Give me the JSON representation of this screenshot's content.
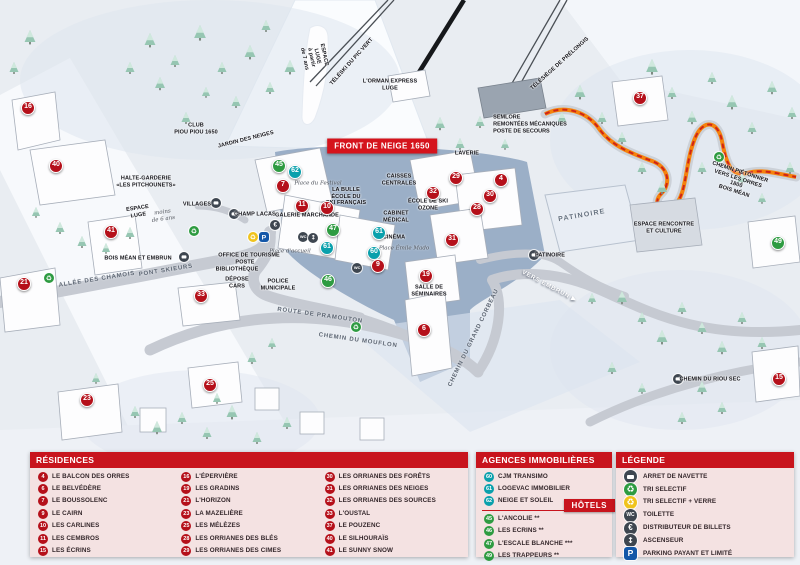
{
  "colors": {
    "primary_red": "#c8141d",
    "residence_red": "#b5101a",
    "hotel_green": "#2e9b41",
    "agency_teal": "#0aa0ac",
    "parking_blue": "#1457a8",
    "path_orange": "#f5820c"
  },
  "map": {
    "banner": "FRONT DE NEIGE 1650",
    "markers": [
      {
        "n": "16",
        "type": "r",
        "x": 28,
        "y": 108
      },
      {
        "n": "40",
        "type": "r",
        "x": 56,
        "y": 166
      },
      {
        "n": "41",
        "type": "r",
        "x": 111,
        "y": 232
      },
      {
        "n": "21",
        "type": "r",
        "x": 24,
        "y": 284
      },
      {
        "n": "33",
        "type": "r",
        "x": 201,
        "y": 296
      },
      {
        "n": "23",
        "type": "r",
        "x": 87,
        "y": 400
      },
      {
        "n": "25",
        "type": "r",
        "x": 210,
        "y": 385
      },
      {
        "n": "45",
        "type": "h",
        "x": 279,
        "y": 166
      },
      {
        "n": "62",
        "type": "a",
        "x": 295,
        "y": 172
      },
      {
        "n": "7",
        "type": "r",
        "x": 283,
        "y": 186
      },
      {
        "n": "11",
        "type": "r",
        "x": 302,
        "y": 206
      },
      {
        "n": "10",
        "type": "r",
        "x": 327,
        "y": 208
      },
      {
        "n": "47",
        "type": "h",
        "x": 333,
        "y": 230
      },
      {
        "n": "61",
        "type": "a",
        "x": 327,
        "y": 248
      },
      {
        "n": "61",
        "type": "a",
        "x": 379,
        "y": 233
      },
      {
        "n": "60",
        "type": "a",
        "x": 374,
        "y": 253
      },
      {
        "n": "9",
        "type": "r",
        "x": 378,
        "y": 266
      },
      {
        "n": "46",
        "type": "h",
        "x": 328,
        "y": 281
      },
      {
        "n": "19",
        "type": "r",
        "x": 426,
        "y": 276
      },
      {
        "n": "6",
        "type": "r",
        "x": 424,
        "y": 330
      },
      {
        "n": "29",
        "type": "r",
        "x": 456,
        "y": 178
      },
      {
        "n": "4",
        "type": "r",
        "x": 501,
        "y": 180
      },
      {
        "n": "32",
        "type": "r",
        "x": 433,
        "y": 193
      },
      {
        "n": "30",
        "type": "r",
        "x": 490,
        "y": 196
      },
      {
        "n": "28",
        "type": "r",
        "x": 477,
        "y": 209
      },
      {
        "n": "31",
        "type": "r",
        "x": 452,
        "y": 240
      },
      {
        "n": "37",
        "type": "r",
        "x": 640,
        "y": 98
      },
      {
        "n": "49",
        "type": "h",
        "x": 778,
        "y": 243
      },
      {
        "n": "15",
        "type": "r",
        "x": 779,
        "y": 379
      }
    ],
    "labels": [
      {
        "t": "CLUB\nPIOU PIOU 1650",
        "x": 196,
        "y": 129,
        "r": 0,
        "c": "poi"
      },
      {
        "t": "JARDIN DES NEIGES",
        "x": 246,
        "y": 140,
        "r": -14,
        "c": "poi"
      },
      {
        "t": "ESPACE\nLUGE\nà partir\nde 7 ans",
        "x": 314,
        "y": 57,
        "r": 78,
        "c": "poi"
      },
      {
        "t": "TÉLÉSKI DU PIC VERT",
        "x": 352,
        "y": 62,
        "r": -48,
        "c": "poi"
      },
      {
        "t": "L'ORMAN EXPRESS\nLUGE",
        "x": 390,
        "y": 85,
        "r": 0,
        "c": "poi"
      },
      {
        "t": "TÉLÉSIÈGE DE PRÉLONGIS",
        "x": 560,
        "y": 64,
        "r": -42,
        "c": "poi"
      },
      {
        "t": "SEMLORE\nREMONTÉES MÉCANIQUES\nPOSTE DE SECOURS",
        "x": 530,
        "y": 125,
        "r": 0,
        "c": "poileft"
      },
      {
        "t": "LAVERIE",
        "x": 467,
        "y": 154,
        "r": 0,
        "c": "poi"
      },
      {
        "t": "HALTE-GARDERIE\n«LES PITCHOUNETS»",
        "x": 146,
        "y": 182,
        "r": 0,
        "c": "poi"
      },
      {
        "t": "VILLAGES",
        "x": 197,
        "y": 205,
        "r": 0,
        "c": "poi"
      },
      {
        "t": "ESPACE\nLUGE",
        "x": 138,
        "y": 212,
        "r": -8,
        "c": "poi"
      },
      {
        "t": "moins\nde 6 ans",
        "x": 163,
        "y": 216,
        "r": -8,
        "c": "place"
      },
      {
        "t": "CHAMP LACAS",
        "x": 255,
        "y": 215,
        "r": 0,
        "c": "poi"
      },
      {
        "t": "BOIS MÉAN ET EMBRUN",
        "x": 138,
        "y": 259,
        "r": 0,
        "c": "poi"
      },
      {
        "t": "OFFICE DE TOURISME",
        "x": 249,
        "y": 256,
        "r": 0,
        "c": "poi"
      },
      {
        "t": "POSTE",
        "x": 245,
        "y": 263,
        "r": 0,
        "c": "poi"
      },
      {
        "t": "BIBLIOTHÈQUE",
        "x": 237,
        "y": 270,
        "r": 0,
        "c": "poi"
      },
      {
        "t": "DÉPOSE\nCARS",
        "x": 237,
        "y": 283,
        "r": 0,
        "c": "poi"
      },
      {
        "t": "POLICE\nMUNICIPALE",
        "x": 278,
        "y": 285,
        "r": 0,
        "c": "poi"
      },
      {
        "t": "Place d'accueil",
        "x": 290,
        "y": 252,
        "r": 0,
        "c": "place"
      },
      {
        "t": "Place du Festival",
        "x": 318,
        "y": 184,
        "r": 0,
        "c": "place"
      },
      {
        "t": "Place Émile Mado",
        "x": 404,
        "y": 249,
        "r": 0,
        "c": "place"
      },
      {
        "t": "LA BULLE\nÉCOLE DU\nSKI FRANÇAIS",
        "x": 346,
        "y": 197,
        "r": 0,
        "c": "poi"
      },
      {
        "t": "GALERIE MARCHANDE",
        "x": 307,
        "y": 216,
        "r": 0,
        "c": "poi"
      },
      {
        "t": "CAISSES\nCENTRALES",
        "x": 399,
        "y": 180,
        "r": 0,
        "c": "poi"
      },
      {
        "t": "CABINET\nMÉDICAL",
        "x": 396,
        "y": 217,
        "r": 0,
        "c": "poi"
      },
      {
        "t": "CINÉMA",
        "x": 394,
        "y": 238,
        "r": 0,
        "c": "poi"
      },
      {
        "t": "ÉCOLE DE SKI\nOZONE",
        "x": 428,
        "y": 205,
        "r": 0,
        "c": "poi"
      },
      {
        "t": "SALLE DE\nSÉMINAIRES",
        "x": 429,
        "y": 291,
        "r": 0,
        "c": "poi"
      },
      {
        "t": "PATINOIRE",
        "x": 550,
        "y": 256,
        "r": 0,
        "c": "poi"
      },
      {
        "t": "PATINOIRE",
        "x": 582,
        "y": 216,
        "r": -10,
        "c": "rink"
      },
      {
        "t": "ESPACE RENCONTRE\nET CULTURE",
        "x": 664,
        "y": 228,
        "r": 0,
        "c": "poi"
      },
      {
        "t": "CHEMIN PIÉTONNIER\nVERS LES ORRES 1800\nBOIS MÉAN",
        "x": 737,
        "y": 182,
        "r": 18,
        "c": "poi"
      },
      {
        "t": "CHEMIN DU RIOU SEC",
        "x": 710,
        "y": 380,
        "r": 0,
        "c": "poi"
      },
      {
        "t": "ALLÉE DES CHAMOIS",
        "x": 97,
        "y": 280,
        "r": -9,
        "c": "road"
      },
      {
        "t": "PONT SKIEURS",
        "x": 166,
        "y": 271,
        "r": -9,
        "c": "road"
      },
      {
        "t": "ROUTE DE PRAMOUTON",
        "x": 320,
        "y": 316,
        "r": 8,
        "c": "road"
      },
      {
        "t": "CHEMIN DU MOUFLON",
        "x": 358,
        "y": 341,
        "r": 8,
        "c": "road"
      },
      {
        "t": "CHEMIN DU GRAND CORBEAU",
        "x": 474,
        "y": 338,
        "r": -64,
        "c": "road"
      },
      {
        "t": "VERS EMBRUN ▶",
        "x": 549,
        "y": 287,
        "r": 28,
        "c": "roadwhite"
      }
    ],
    "icons": [
      {
        "k": "bus",
        "x": 216,
        "y": 203
      },
      {
        "k": "bus",
        "x": 234,
        "y": 214
      },
      {
        "k": "bus",
        "x": 184,
        "y": 257
      },
      {
        "k": "bus",
        "x": 534,
        "y": 255
      },
      {
        "k": "bus",
        "x": 678,
        "y": 379
      },
      {
        "k": "recycle",
        "x": 194,
        "y": 231
      },
      {
        "k": "recycle",
        "x": 49,
        "y": 278
      },
      {
        "k": "recycle",
        "x": 356,
        "y": 327
      },
      {
        "k": "recycle",
        "x": 719,
        "y": 157
      },
      {
        "k": "glass",
        "x": 253,
        "y": 237
      },
      {
        "k": "park",
        "x": 264,
        "y": 237
      },
      {
        "k": "euro",
        "x": 275,
        "y": 225
      },
      {
        "k": "wc",
        "x": 303,
        "y": 237
      },
      {
        "k": "lift",
        "x": 313,
        "y": 238
      },
      {
        "k": "wc",
        "x": 357,
        "y": 268
      }
    ]
  },
  "legend": {
    "residences": {
      "title": "RÉSIDENCES",
      "items": [
        {
          "n": "4",
          "label": "LE BALCON DES ORRES"
        },
        {
          "n": "6",
          "label": "LE BELVÉDÈRE"
        },
        {
          "n": "7",
          "label": "LE BOUSSOLENC"
        },
        {
          "n": "9",
          "label": "LE CAIRN"
        },
        {
          "n": "10",
          "label": "LES CARLINES"
        },
        {
          "n": "11",
          "label": "LES CEMBROS"
        },
        {
          "n": "15",
          "label": "LES ÉCRINS"
        },
        {
          "n": "16",
          "label": "L'ÉPERVIÈRE"
        },
        {
          "n": "19",
          "label": "LES GRADINS"
        },
        {
          "n": "21",
          "label": "L'HORIZON"
        },
        {
          "n": "23",
          "label": "LA MAZELIÈRE"
        },
        {
          "n": "25",
          "label": "LES MÉLÈZES"
        },
        {
          "n": "28",
          "label": "LES ORRIANES DES BLÉS"
        },
        {
          "n": "29",
          "label": "LES ORRIANES DES CIMES"
        },
        {
          "n": "30",
          "label": "LES ORRIANES DES FORÊTS"
        },
        {
          "n": "31",
          "label": "LES ORRIANES DES NEIGES"
        },
        {
          "n": "32",
          "label": "LES ORRIANES DES SOURCES"
        },
        {
          "n": "33",
          "label": "L'OUSTAL"
        },
        {
          "n": "37",
          "label": "LE POUZENC"
        },
        {
          "n": "40",
          "label": "LE SILHOURAÏS"
        },
        {
          "n": "41",
          "label": "LE SUNNY SNOW"
        }
      ]
    },
    "agences": {
      "title": "AGENCES IMMOBILIÈRES",
      "items": [
        {
          "n": "60",
          "label": "CJM TRANSIMO"
        },
        {
          "n": "61",
          "label": "LOGEVAC IMMOBILIER"
        },
        {
          "n": "62",
          "label": "NEIGE ET SOLEIL"
        }
      ]
    },
    "hotels": {
      "title": "HÔTELS",
      "items": [
        {
          "n": "45",
          "label": "L'ANCOLIE **"
        },
        {
          "n": "46",
          "label": "LES ECRINS **"
        },
        {
          "n": "47",
          "label": "L'ESCALE BLANCHE ***"
        },
        {
          "n": "49",
          "label": "LES TRAPPEURS **"
        }
      ]
    },
    "legende": {
      "title": "LÉGENDE",
      "items": [
        {
          "icon": "bus",
          "label": "ARRET DE NAVETTE"
        },
        {
          "icon": "recycle",
          "label": "TRI SELECTIF"
        },
        {
          "icon": "glass",
          "label": "TRI SELECTIF + VERRE"
        },
        {
          "icon": "wc",
          "label": "TOILETTE"
        },
        {
          "icon": "euro",
          "label": "DISTRIBUTEUR DE BILLETS"
        },
        {
          "icon": "lift",
          "label": "ASCENSEUR"
        },
        {
          "icon": "park",
          "label": "PARKING PAYANT ET LIMITÉ"
        }
      ]
    }
  }
}
